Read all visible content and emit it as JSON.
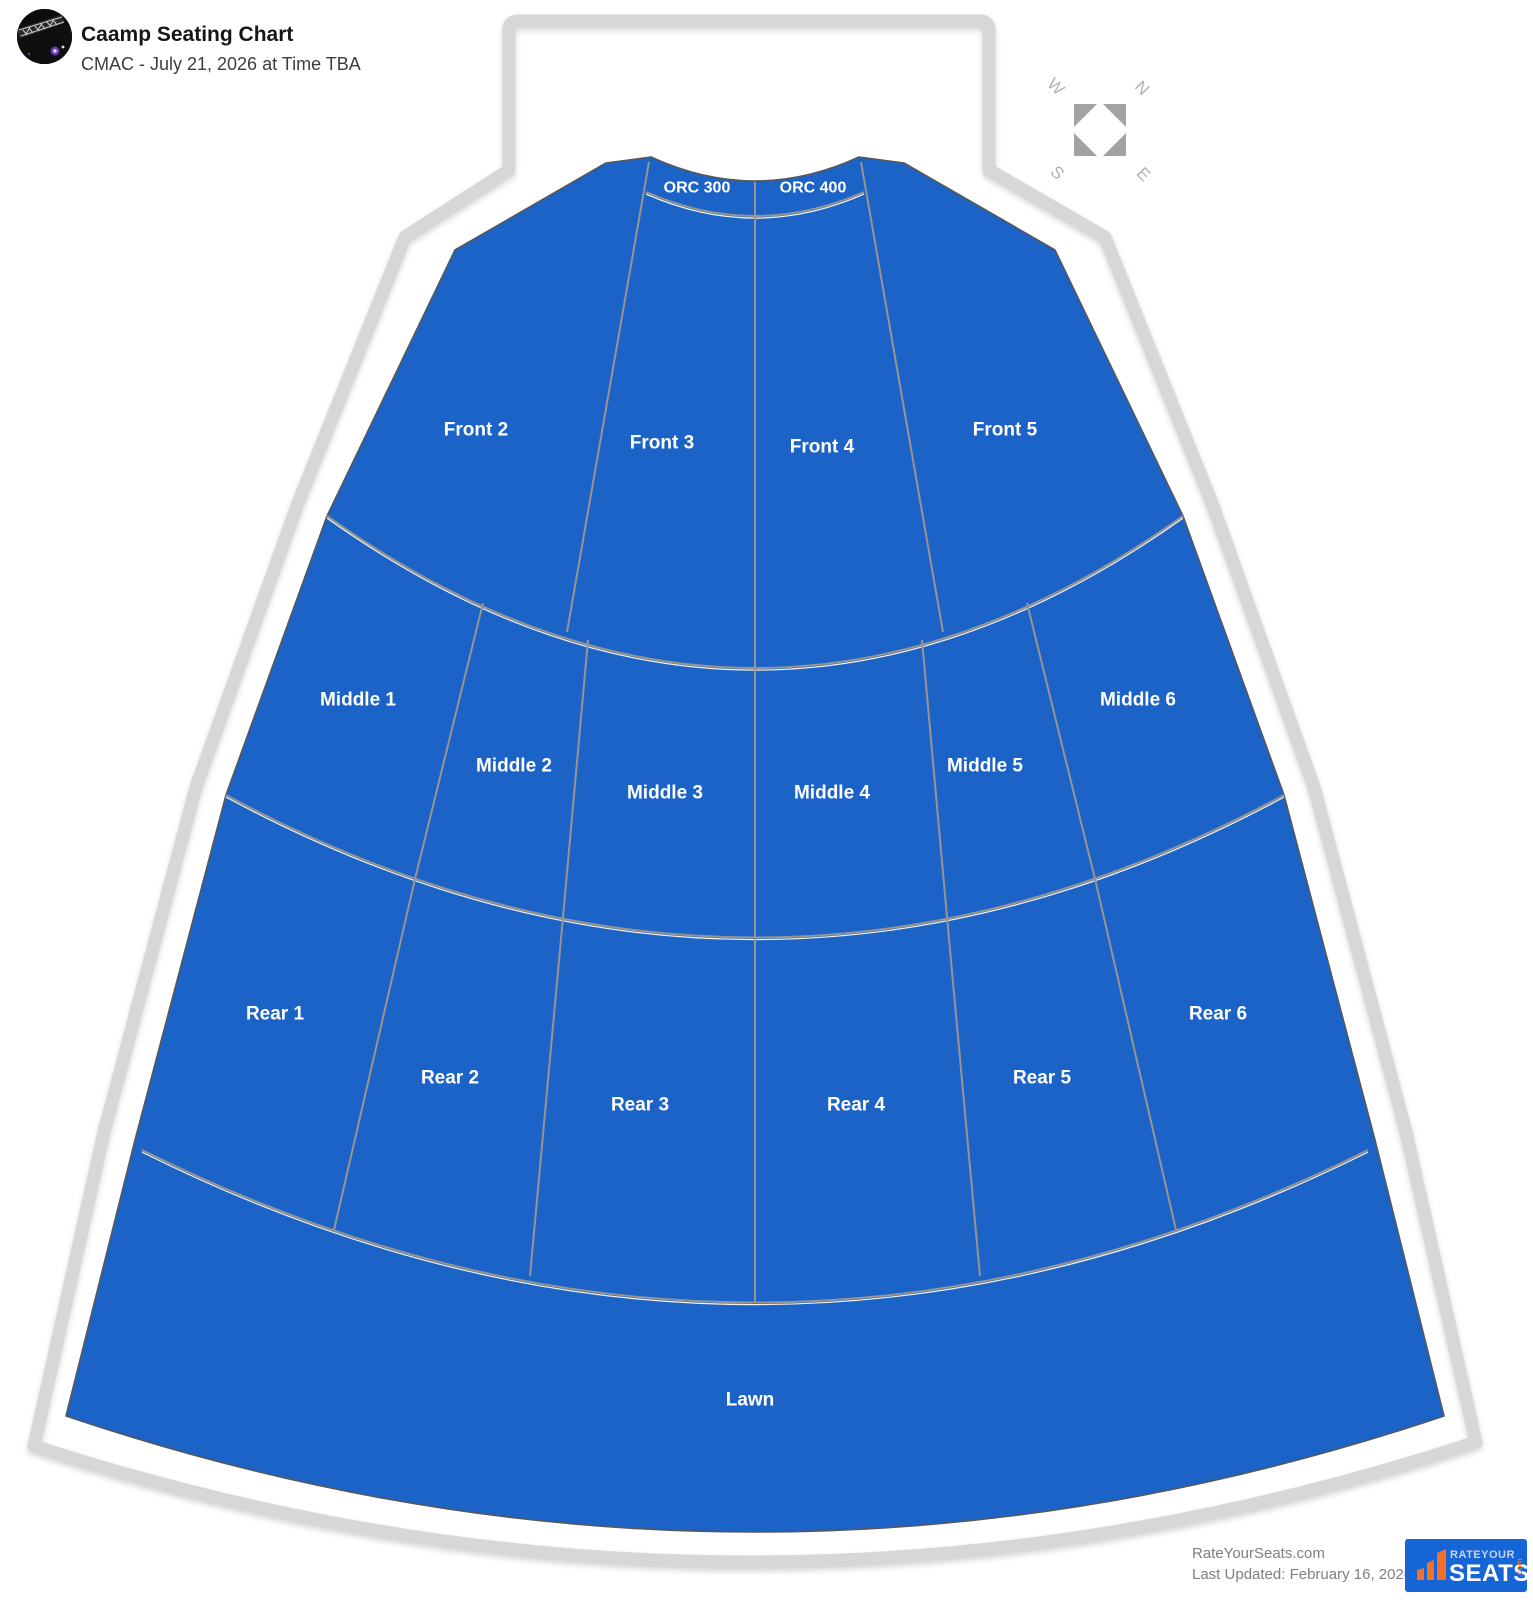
{
  "header": {
    "title": "Caamp Seating Chart",
    "subtitle": "CMAC - July 21, 2026 at Time TBA"
  },
  "compass": {
    "west": "W",
    "north": "N",
    "south": "S",
    "east": "E"
  },
  "map": {
    "colors": {
      "section_fill": "#1c63c7",
      "section_edge": "#54575c",
      "divider_line": "#98958f",
      "divider_highlight": "#f4f2ec",
      "venue_outline": "#d7d7d7",
      "label_text": "#ffffff"
    },
    "sections": [
      {
        "id": "orc-300",
        "label": "ORC 300",
        "x": 697,
        "y": 188,
        "size": 16
      },
      {
        "id": "orc-400",
        "label": "ORC 400",
        "x": 813,
        "y": 188,
        "size": 16
      },
      {
        "id": "front-2",
        "label": "Front 2",
        "x": 476,
        "y": 430,
        "size": 19
      },
      {
        "id": "front-3",
        "label": "Front 3",
        "x": 662,
        "y": 443,
        "size": 19
      },
      {
        "id": "front-4",
        "label": "Front 4",
        "x": 822,
        "y": 447,
        "size": 19
      },
      {
        "id": "front-5",
        "label": "Front 5",
        "x": 1005,
        "y": 430,
        "size": 19
      },
      {
        "id": "middle-1",
        "label": "Middle 1",
        "x": 358,
        "y": 700,
        "size": 19
      },
      {
        "id": "middle-2",
        "label": "Middle 2",
        "x": 514,
        "y": 766,
        "size": 19
      },
      {
        "id": "middle-3",
        "label": "Middle 3",
        "x": 665,
        "y": 793,
        "size": 19
      },
      {
        "id": "middle-4",
        "label": "Middle 4",
        "x": 832,
        "y": 793,
        "size": 19
      },
      {
        "id": "middle-5",
        "label": "Middle 5",
        "x": 985,
        "y": 766,
        "size": 19
      },
      {
        "id": "middle-6",
        "label": "Middle 6",
        "x": 1138,
        "y": 700,
        "size": 19
      },
      {
        "id": "rear-1",
        "label": "Rear 1",
        "x": 275,
        "y": 1014,
        "size": 19
      },
      {
        "id": "rear-2",
        "label": "Rear 2",
        "x": 450,
        "y": 1078,
        "size": 19
      },
      {
        "id": "rear-3",
        "label": "Rear 3",
        "x": 640,
        "y": 1105,
        "size": 19
      },
      {
        "id": "rear-4",
        "label": "Rear 4",
        "x": 856,
        "y": 1105,
        "size": 19
      },
      {
        "id": "rear-5",
        "label": "Rear 5",
        "x": 1042,
        "y": 1078,
        "size": 19
      },
      {
        "id": "rear-6",
        "label": "Rear 6",
        "x": 1218,
        "y": 1014,
        "size": 19
      },
      {
        "id": "lawn",
        "label": "Lawn",
        "x": 750,
        "y": 1400,
        "size": 19
      }
    ]
  },
  "footer": {
    "site_name": "RateYourSeats.com",
    "last_updated": "Last Updated: February 16, 2026",
    "logo": {
      "brand_top": "RATEYOUR",
      "brand_main": "SEATS",
      "brand_suffix": ".com"
    }
  }
}
